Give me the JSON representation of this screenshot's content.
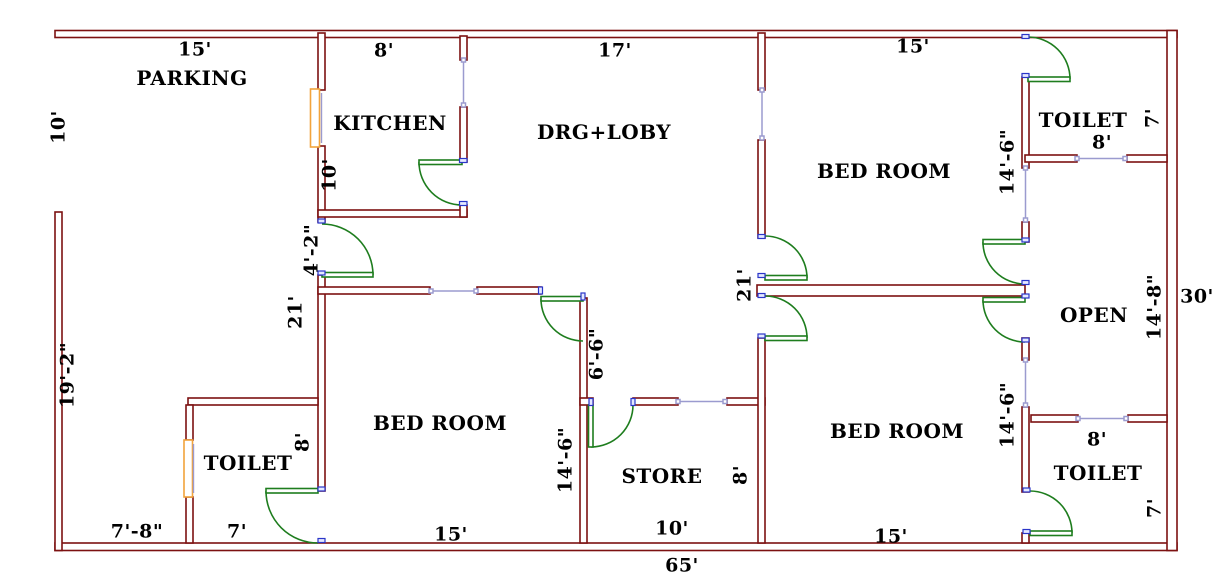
{
  "plan_title": "house floor plan drawing",
  "colors": {
    "wall": "#7c1111",
    "door": "#1e7d1e",
    "window_frame": "#f2a33c",
    "opening_line": "#9b9bcf",
    "jamb_marker": "#2a35c8",
    "text": "#000000",
    "background": "#ffffff"
  },
  "rooms": [
    {
      "label": "PARKING"
    },
    {
      "label": "KITCHEN"
    },
    {
      "label": "DRG+LOBY"
    },
    {
      "label": "BED ROOM"
    },
    {
      "label": "TOILET"
    },
    {
      "label": "OPEN"
    },
    {
      "label": "BED ROOM"
    },
    {
      "label": "TOILET"
    },
    {
      "label": "STORE"
    },
    {
      "label": "BED ROOM"
    },
    {
      "label": "TOILET"
    }
  ],
  "dimensions": [
    {
      "text": "15'"
    },
    {
      "text": "8'"
    },
    {
      "text": "17'"
    },
    {
      "text": "15'"
    },
    {
      "text": "10'"
    },
    {
      "text": "10'"
    },
    {
      "text": "4'-2\""
    },
    {
      "text": "21'"
    },
    {
      "text": "19'-2\""
    },
    {
      "text": "7'-8\""
    },
    {
      "text": "7'"
    },
    {
      "text": "8'"
    },
    {
      "text": "15'"
    },
    {
      "text": "14'-6\""
    },
    {
      "text": "6'-6\""
    },
    {
      "text": "10'"
    },
    {
      "text": "8'"
    },
    {
      "text": "65'"
    },
    {
      "text": "21'"
    },
    {
      "text": "15'"
    },
    {
      "text": "14'-6\""
    },
    {
      "text": "8'"
    },
    {
      "text": "7'"
    },
    {
      "text": "14'-8\""
    },
    {
      "text": "30'"
    },
    {
      "text": "14'-6\""
    },
    {
      "text": "8'"
    },
    {
      "text": "7'"
    }
  ]
}
